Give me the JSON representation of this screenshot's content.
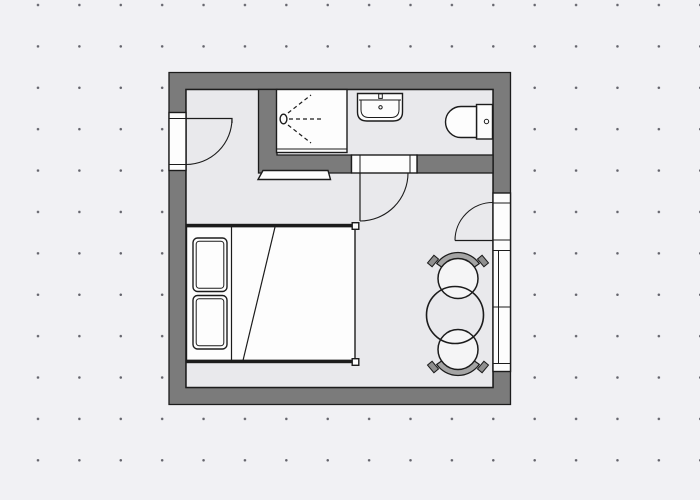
{
  "meta": {
    "title": "Room floor plan",
    "aria_label": "Architectural floor plan of a studio room: bathroom strip at top with shower, washbasin and toilet; double bed with two pillows on the left; round table with two chairs at the right window; three swing doors and a wall-mounted TV"
  },
  "cssvars": {
    "canvas-bg": "#f1f1f4",
    "grid-dot": "#63636b",
    "grid-spacing": "41.4px",
    "grid-offset": "17.3px -15.7px",
    "wall-fill": "#7b7b7b",
    "floor-fill": "#e9e9ec",
    "line": "#1c1c1c",
    "white": "#fdfdfd",
    "seat-fill": "#f5f5f6",
    "backrest-light": "#a4a4a4",
    "backrest-mid": "#8f8f8f",
    "backrest-dark": "#5c5c5c"
  },
  "rooms": {
    "bathroom": "Bathroom",
    "main": "Main room",
    "entry": "Entry nook"
  },
  "fixtures": {
    "outer_walls": "Outer walls",
    "floor": "Floor",
    "partition": "Bathroom partition wall",
    "shower": "Shower",
    "sink": "Washbasin",
    "toilet": "Toilet",
    "tv": "Wall-mounted TV",
    "bed": "Double bed",
    "pillow_top": "Pillow",
    "pillow_bottom": "Pillow",
    "blanket_fold": "Blanket fold",
    "table": "Round table",
    "chair_top": "Chair",
    "chair_bottom": "Chair",
    "left_door": "Side door",
    "bathroom_door": "Bathroom door",
    "entry_door": "Entrance door",
    "window": "Window"
  }
}
